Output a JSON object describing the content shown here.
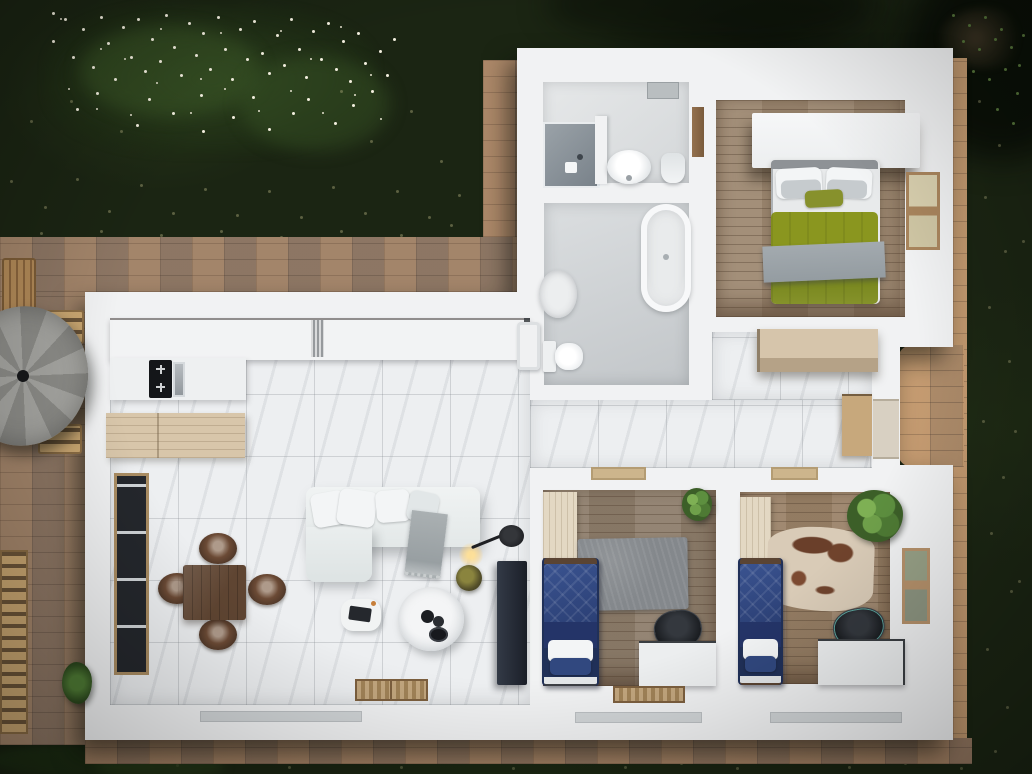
{
  "scene": {
    "title": "Top-down 3D rendered floor plan of an apartment with garden and brick patio",
    "view": "top-down",
    "style": "photorealistic architectural visualization",
    "canvas": {
      "width": 1032,
      "height": 774
    }
  },
  "palette": {
    "lawn": "#1b2513",
    "flowers": "#f3efdf",
    "patio_brick": "#a3846a",
    "patio_bright": "#c39d75",
    "wall_white": "#f1f2f3",
    "marble_floor": "#edeff1",
    "wood_master": "#9d8871",
    "wood_bedroom1": "#8d7d6b",
    "wood_bedroom2": "#9a8268",
    "bed_navy": "#2b3f74",
    "duvet_olive": "#87912c",
    "blanket_gray": "#9ba3a8",
    "sofa_white": "#e9eced",
    "rug_gray": "#868a8e",
    "cowhide": "#d9cbb7",
    "dining_walnut": "#5f4532",
    "island_ash": "#d8c6aa",
    "umbrella_gray": "#9b9b97",
    "tv_unit": "#2c323c",
    "plant_green": "#4e7a34"
  },
  "outdoor": {
    "lawn": {
      "description": "dark green grass with light speckles"
    },
    "flower_bed": {
      "position": "top-left",
      "description": "shrubs with white blossoms"
    },
    "trees": {
      "position": "top-right",
      "description": "tree canopy overhanging the lawn"
    },
    "patio": {
      "description": "brick paver terrace wrapping the house",
      "areas": [
        "left strip",
        "top band",
        "entry strip",
        "right strip",
        "side terrace",
        "bottom band"
      ]
    },
    "furniture": [
      {
        "name": "gray parasol"
      },
      {
        "name": "wooden chair"
      },
      {
        "name": "wooden bench"
      },
      {
        "name": "slatted sun lounger"
      },
      {
        "name": "potted palm"
      }
    ]
  },
  "house": {
    "walls_color": "#f1f2f3",
    "rooms": [
      {
        "id": "living-kitchen",
        "name": "Living room and kitchen",
        "floor": "white marble tile",
        "furniture": [
          "white kitchen counter",
          "radiator",
          "induction cooktop",
          "steel sink",
          "light wood island",
          "walnut dining table",
          "four leather barrel chairs",
          "white corner sofa",
          "gray throw blanket",
          "fluffy pouf coffee table",
          "round side table",
          "arc floor lamp",
          "dark tv cabinet",
          "tall window",
          "two doormats"
        ]
      },
      {
        "id": "shower-room",
        "name": "Shower room",
        "floor": "light gray tile",
        "furniture": [
          "walk-in shower",
          "round washbasin",
          "toilet",
          "wooden door"
        ]
      },
      {
        "id": "bathroom",
        "name": "Bathroom",
        "floor": "gray tile",
        "furniture": [
          "freestanding bathtub",
          "oval washbasin",
          "toilet",
          "washing machine"
        ]
      },
      {
        "id": "master-bedroom",
        "name": "Master bedroom",
        "floor": "oak planks",
        "furniture": [
          "floating white wardrobe",
          "double bed",
          "white and gray pillows",
          "olive green duvet",
          "gray throw",
          "window"
        ]
      },
      {
        "id": "hallway",
        "name": "Hallway",
        "floor": "white marble tile",
        "furniture": [
          "ash sideboard",
          "tall wooden cabinet",
          "entry door",
          "two threshold mats"
        ]
      },
      {
        "id": "bedroom-1",
        "name": "Bedroom 1",
        "floor": "gray-brown planks",
        "furniture": [
          "cream wardrobe",
          "navy single bed",
          "white pillow",
          "gray shag rug",
          "white desk",
          "black office chair",
          "potted plant",
          "striped doormat"
        ]
      },
      {
        "id": "bedroom-2",
        "name": "Bedroom 2",
        "floor": "warm brown planks",
        "furniture": [
          "cream wardrobe",
          "navy single bed",
          "white pillow",
          "cowhide rug",
          "white desk",
          "black office chair",
          "large potted plant",
          "wall window shelf"
        ]
      }
    ]
  }
}
